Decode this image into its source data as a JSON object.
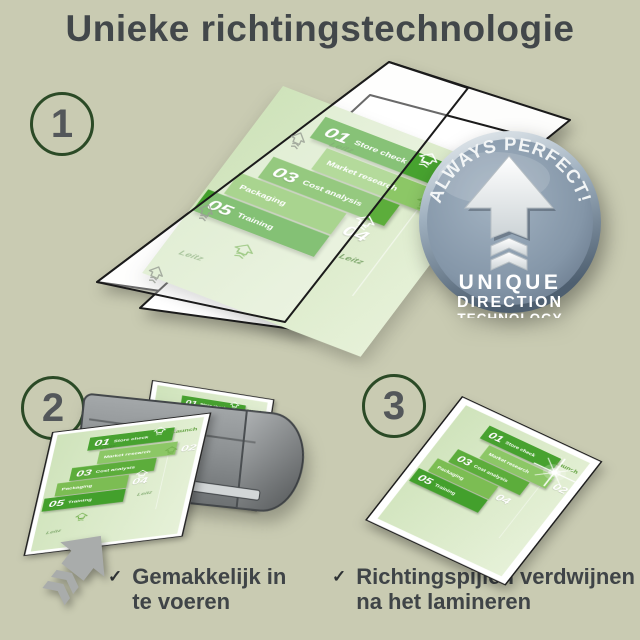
{
  "title": "Unieke richtingstechnologie",
  "steps": [
    {
      "number": "1"
    },
    {
      "number": "2"
    },
    {
      "number": "3"
    }
  ],
  "badge": {
    "arc_text": "ALWAYS PERFECT!",
    "line1": "UNIQUE",
    "line2": "DIRECTION",
    "line3": "TECHNOLOGY"
  },
  "doc": {
    "brand": "Leitz",
    "launch": "Launch",
    "rows": [
      {
        "num": "01",
        "label": "Store check"
      },
      {
        "num": "02",
        "label": "Market research"
      },
      {
        "num": "03",
        "label": "Cost analysis"
      },
      {
        "num": "04",
        "label": "Packaging"
      },
      {
        "num": "05",
        "label": "Training"
      }
    ]
  },
  "checklist": [
    {
      "icon": "✓",
      "line1": "Gemakkelijk in",
      "line2": "te voeren"
    },
    {
      "icon": "✓",
      "line1": "Richtingspijlen verdwijnen",
      "line2": "na het lamineren"
    }
  ],
  "colors": {
    "background": "#c9cbb2",
    "title_text": "#42474a",
    "step_circle_green": "#2b4a26",
    "doc_green_dark": "#47a22f",
    "doc_green_light": "#8cc766",
    "badge_steel": "#8496a8",
    "laminator_gray": "#8d9193"
  }
}
